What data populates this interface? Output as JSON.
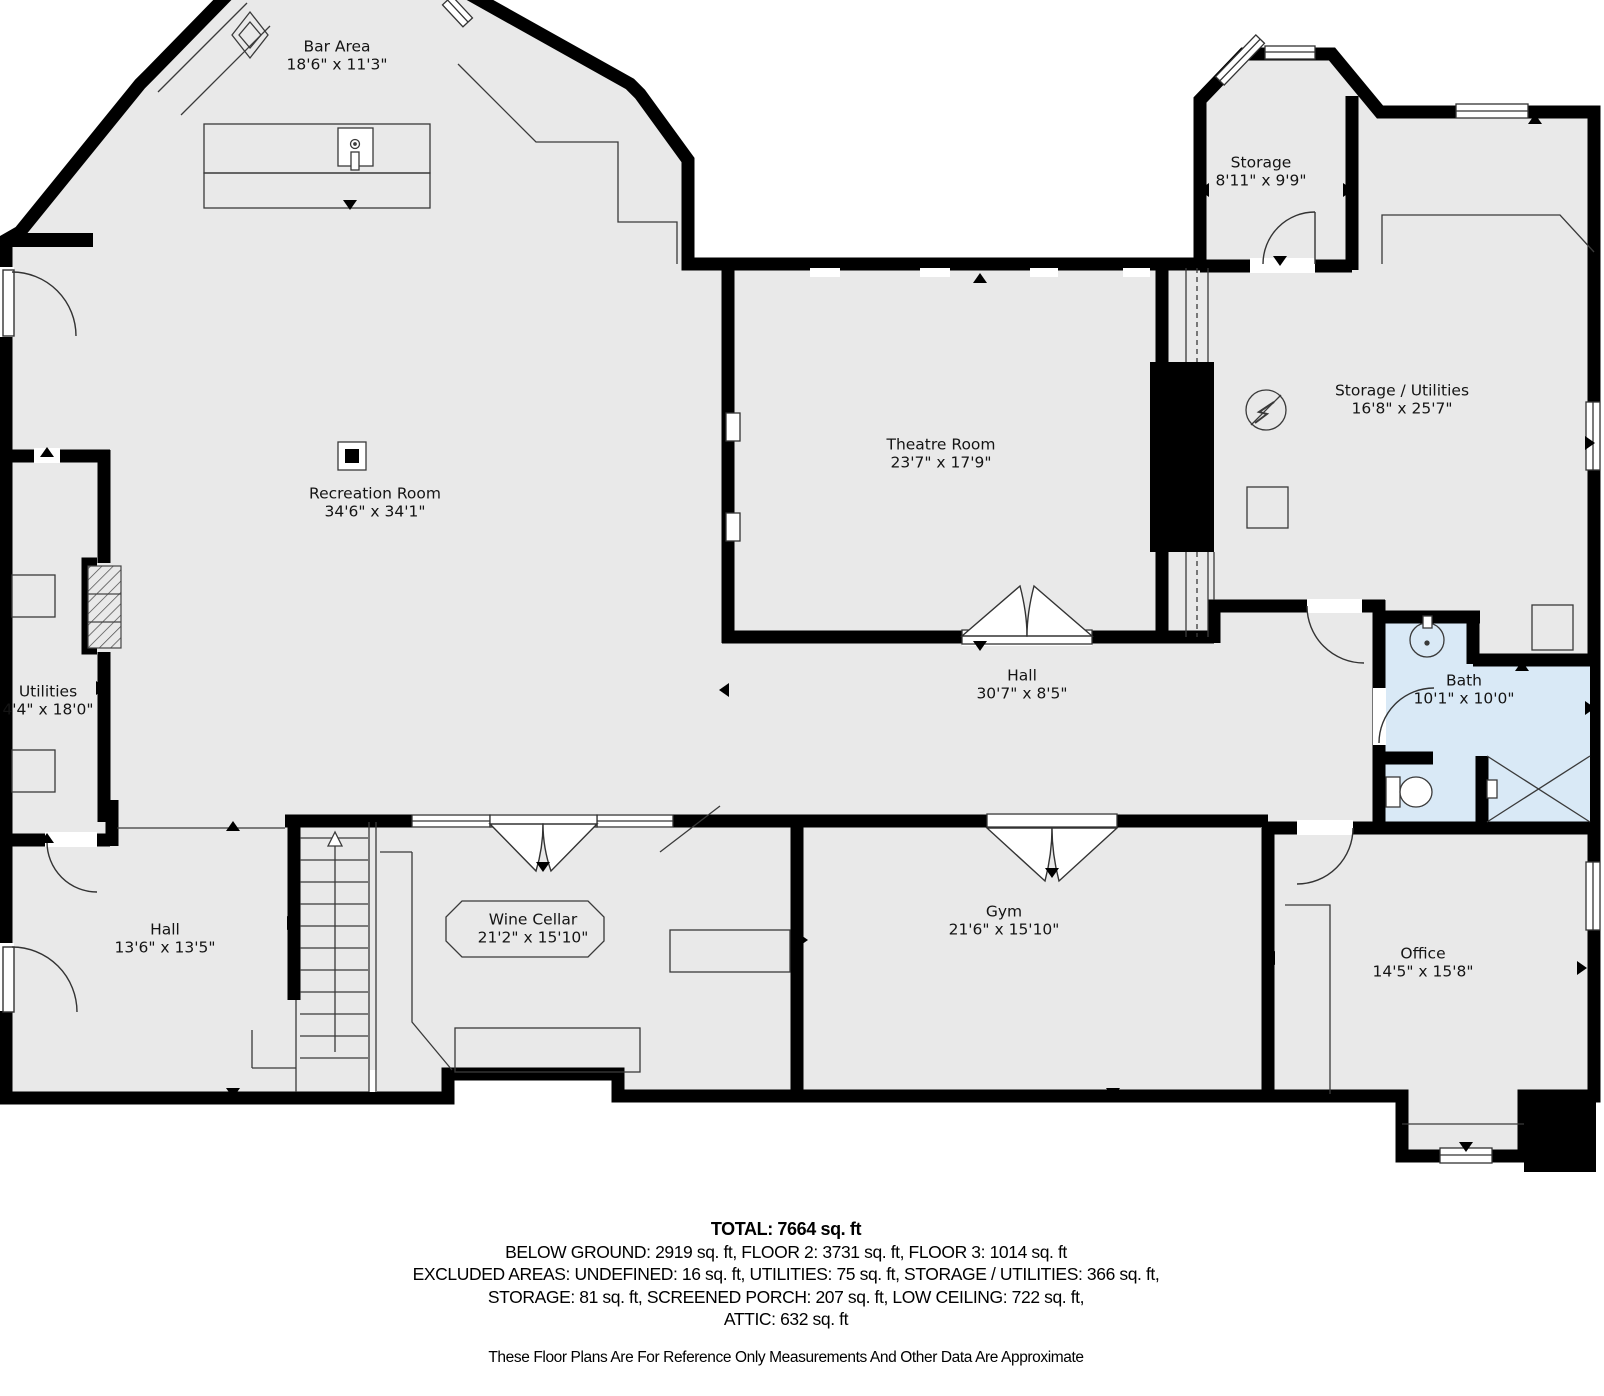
{
  "colors": {
    "floor": "#e9e9e9",
    "bath_floor": "#d9e9f6",
    "wall": "#000000",
    "thin_line": "#3a3a3a"
  },
  "rooms": [
    {
      "id": "bar-area",
      "name": "Bar Area",
      "dims": "18'6\" x 11'3\"",
      "x": 337,
      "y": 56
    },
    {
      "id": "storage",
      "name": "Storage",
      "dims": "8'11\" x 9'9\"",
      "x": 1261,
      "y": 172
    },
    {
      "id": "storage-utilities",
      "name": "Storage / Utilities",
      "dims": "16'8\" x 25'7\"",
      "x": 1402,
      "y": 400
    },
    {
      "id": "theatre-room",
      "name": "Theatre Room",
      "dims": "23'7\" x 17'9\"",
      "x": 941,
      "y": 454
    },
    {
      "id": "recreation-room",
      "name": "Recreation Room",
      "dims": "34'6\" x 34'1\"",
      "x": 375,
      "y": 503
    },
    {
      "id": "utilities",
      "name": "Utilities",
      "dims": "4'4\" x 18'0\"",
      "x": 48,
      "y": 701
    },
    {
      "id": "hall-upper",
      "name": "Hall",
      "dims": "30'7\" x 8'5\"",
      "x": 1022,
      "y": 685
    },
    {
      "id": "bath",
      "name": "Bath",
      "dims": "10'1\" x 10'0\"",
      "x": 1464,
      "y": 690
    },
    {
      "id": "hall-lower",
      "name": "Hall",
      "dims": "13'6\" x 13'5\"",
      "x": 165,
      "y": 939
    },
    {
      "id": "wine-cellar",
      "name": "Wine Cellar",
      "dims": "21'2\" x 15'10\"",
      "x": 533,
      "y": 929
    },
    {
      "id": "gym",
      "name": "Gym",
      "dims": "21'6\" x 15'10\"",
      "x": 1004,
      "y": 921
    },
    {
      "id": "office",
      "name": "Office",
      "dims": "14'5\" x 15'8\"",
      "x": 1423,
      "y": 963
    }
  ],
  "footer": {
    "total": "TOTAL: 7664 sq. ft",
    "lines": [
      "BELOW GROUND: 2919 sq. ft, FLOOR 2: 3731 sq. ft, FLOOR 3: 1014 sq. ft",
      "EXCLUDED AREAS: UNDEFINED: 16 sq. ft, UTILITIES: 75 sq. ft, STORAGE / UTILITIES: 366 sq. ft,",
      "STORAGE: 81 sq. ft, SCREENED PORCH: 207 sq. ft, LOW CEILING: 722 sq. ft,",
      "ATTIC: 632 sq. ft"
    ],
    "disclaimer": "These Floor Plans Are For Reference Only Measurements And Other Data Are Approximate"
  }
}
